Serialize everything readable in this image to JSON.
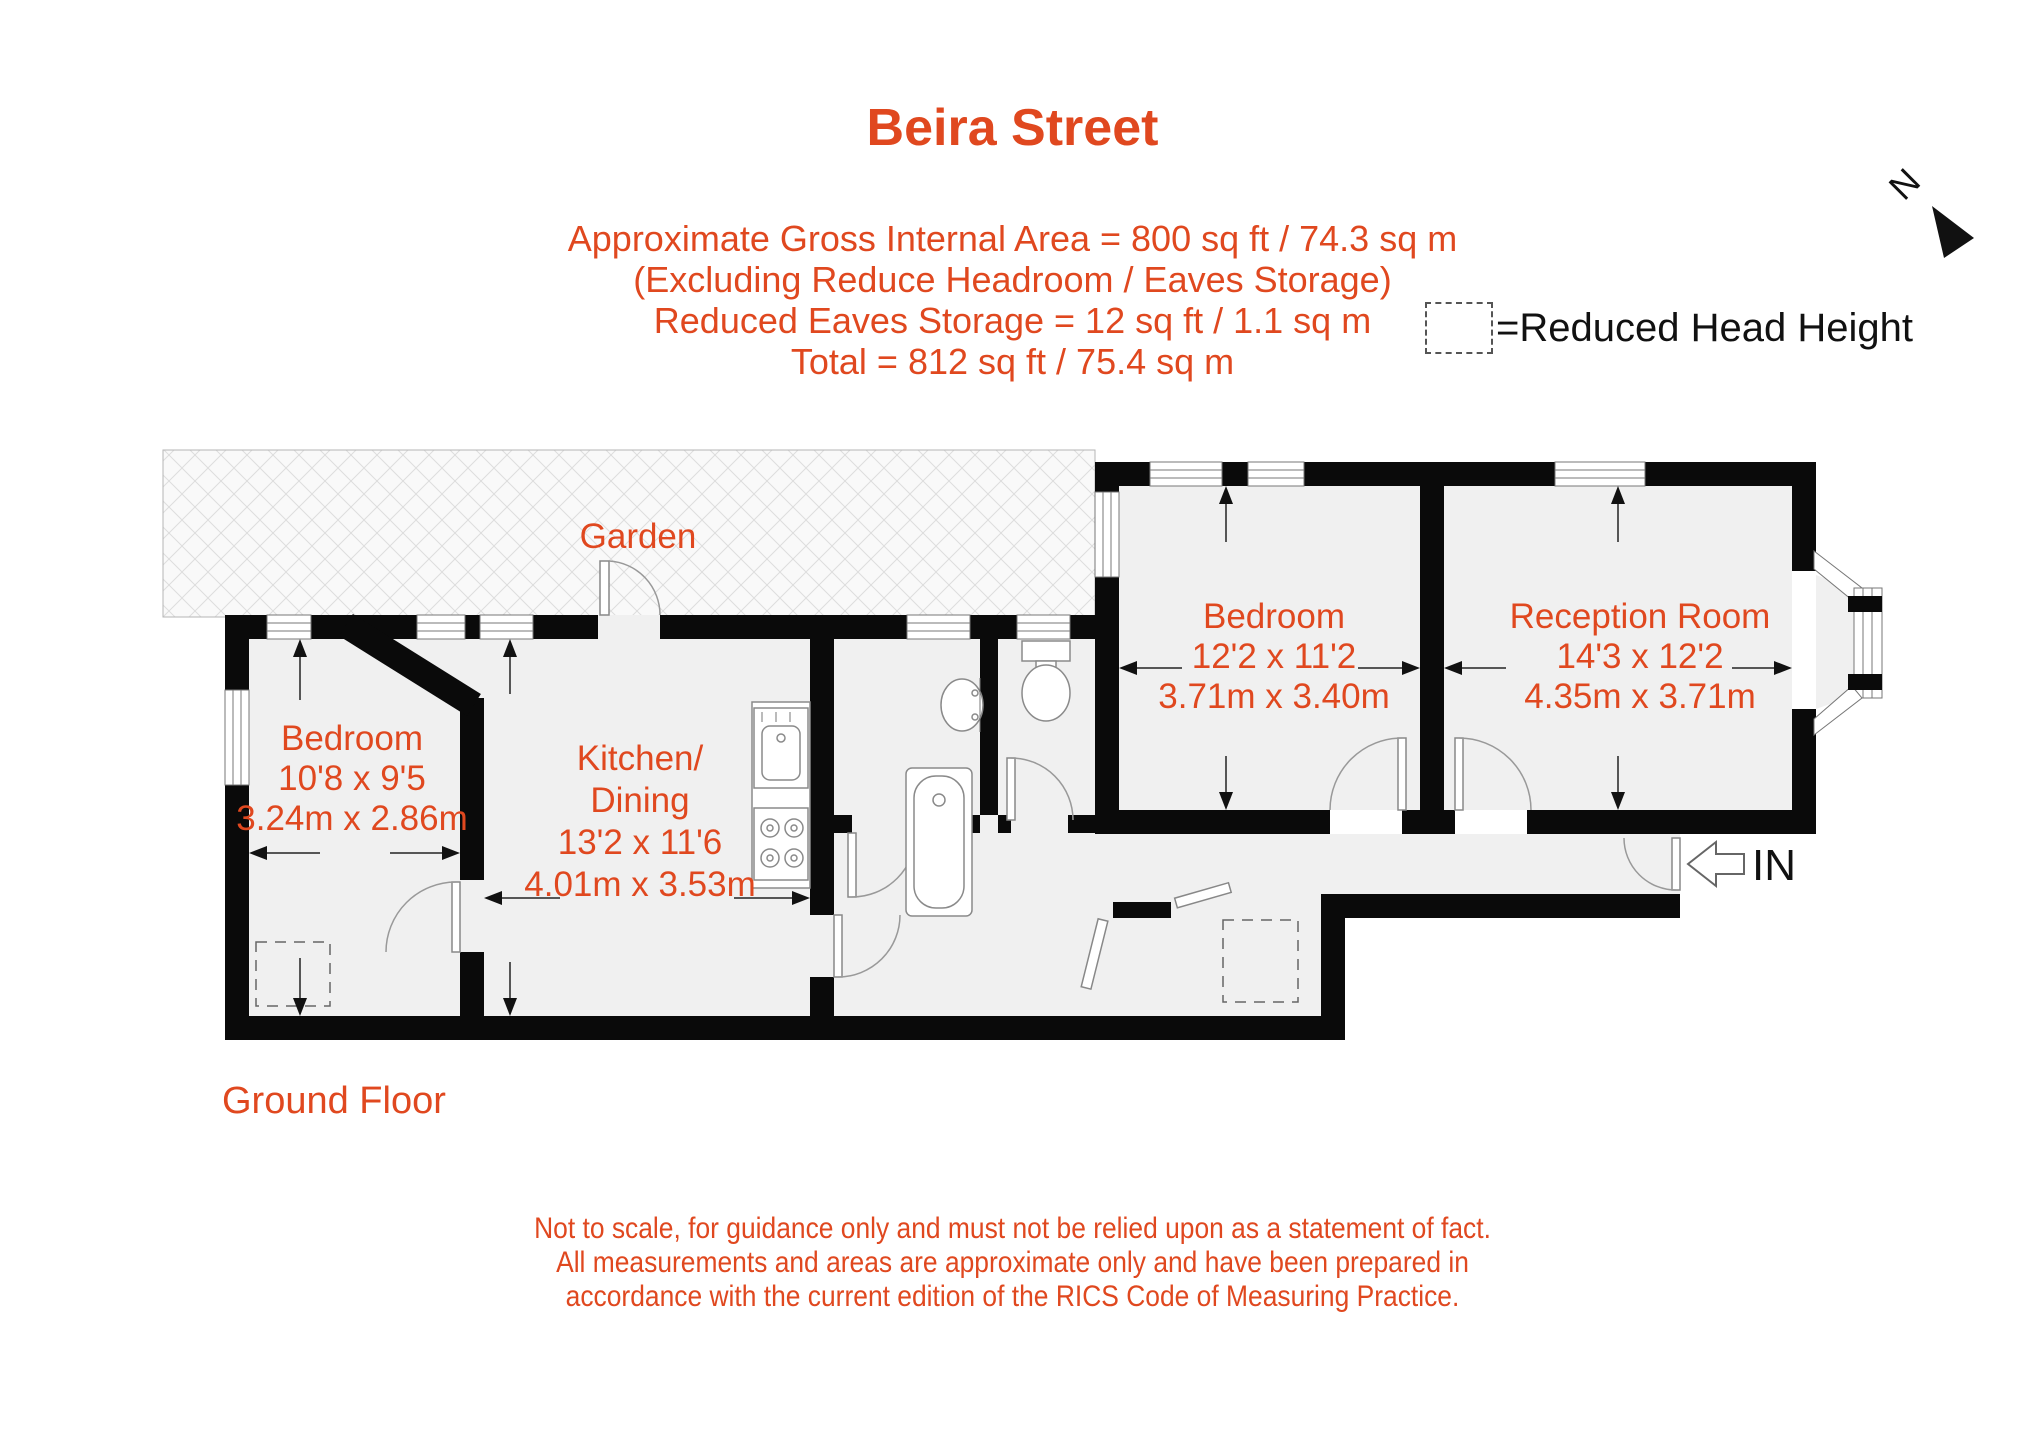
{
  "header": {
    "title": "Beira Street",
    "subtitle_lines": [
      "Approximate Gross Internal Area = 800 sq ft / 74.3 sq m",
      "(Excluding Reduce Headroom / Eaves Storage)",
      "Reduced Eaves Storage = 12 sq ft / 1.1 sq m",
      "Total = 812 sq ft / 75.4 sq m"
    ]
  },
  "legend": {
    "label": "=Reduced Head Height"
  },
  "compass": {
    "label": "N"
  },
  "floor_label": "Ground Floor",
  "entrance_label": "IN",
  "rooms": {
    "garden": {
      "name": "Garden"
    },
    "bedroom_left": {
      "name": "Bedroom",
      "dims_ft": "10'8 x 9'5",
      "dims_m": "3.24m x 2.86m"
    },
    "kitchen_dining": {
      "name_line1": "Kitchen/",
      "name_line2": "Dining",
      "dims_ft": "13'2 x 11'6",
      "dims_m": "4.01m x 3.53m"
    },
    "bedroom_right": {
      "name": "Bedroom",
      "dims_ft": "12'2 x 11'2",
      "dims_m": "3.71m x 3.40m"
    },
    "reception": {
      "name": "Reception Room",
      "dims_ft": "14'3 x 12'2",
      "dims_m": "4.35m x 3.71m"
    }
  },
  "disclaimer_lines": [
    "Not to scale, for guidance only and must not be relied upon as a statement of fact.",
    "All measurements and areas are approximate only and have been prepared in",
    "accordance with the current edition of the RICS Code of Measuring Practice."
  ],
  "colors": {
    "accent": "#E0481F",
    "wall": "#0A0A0A",
    "floor_fill": "#F0F0F0"
  }
}
